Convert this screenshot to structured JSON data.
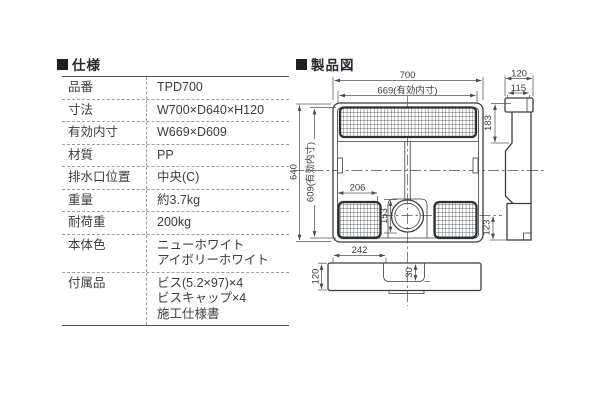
{
  "page": {
    "background": "#ffffff"
  },
  "spec": {
    "heading": "仕様",
    "rows": [
      {
        "label": "品番",
        "value": "TPD700"
      },
      {
        "label": "寸法",
        "value": "W700×D640×H120"
      },
      {
        "label": "有効内寸",
        "value": "W669×D609"
      },
      {
        "label": "材質",
        "value": "PP"
      },
      {
        "label": "排水口位置",
        "value": "中央(C)"
      },
      {
        "label": "重量",
        "value": "約3.7kg"
      },
      {
        "label": "耐荷重",
        "value": "200kg"
      },
      {
        "label": "本体色",
        "value": "ニューホワイト\nアイボリーホワイト"
      },
      {
        "label": "付属品",
        "value": "ビス(5.2×97)×4\nビスキャップ×4\n施工仕様書"
      }
    ]
  },
  "figure": {
    "heading": "製品図",
    "dims": {
      "top_width": "700",
      "top_width_inner": "669(有効内寸)",
      "top_depth": "640",
      "top_depth_inner": "609(有効内寸)",
      "grid_width": "206",
      "drain_offset": "153",
      "front_offset": "242",
      "side_width": "120",
      "side_width_inner": "115",
      "side_upper_height": "183",
      "side_lower_height": "123",
      "front_height": "120",
      "drain_recess_depth": "30"
    }
  },
  "colors": {
    "drawing_line": "#383d42",
    "dimension_line": "#50555a",
    "table_text": "#3a3d41",
    "heading_text": "#26292d",
    "dashed_rule": "#9aa0a5"
  }
}
